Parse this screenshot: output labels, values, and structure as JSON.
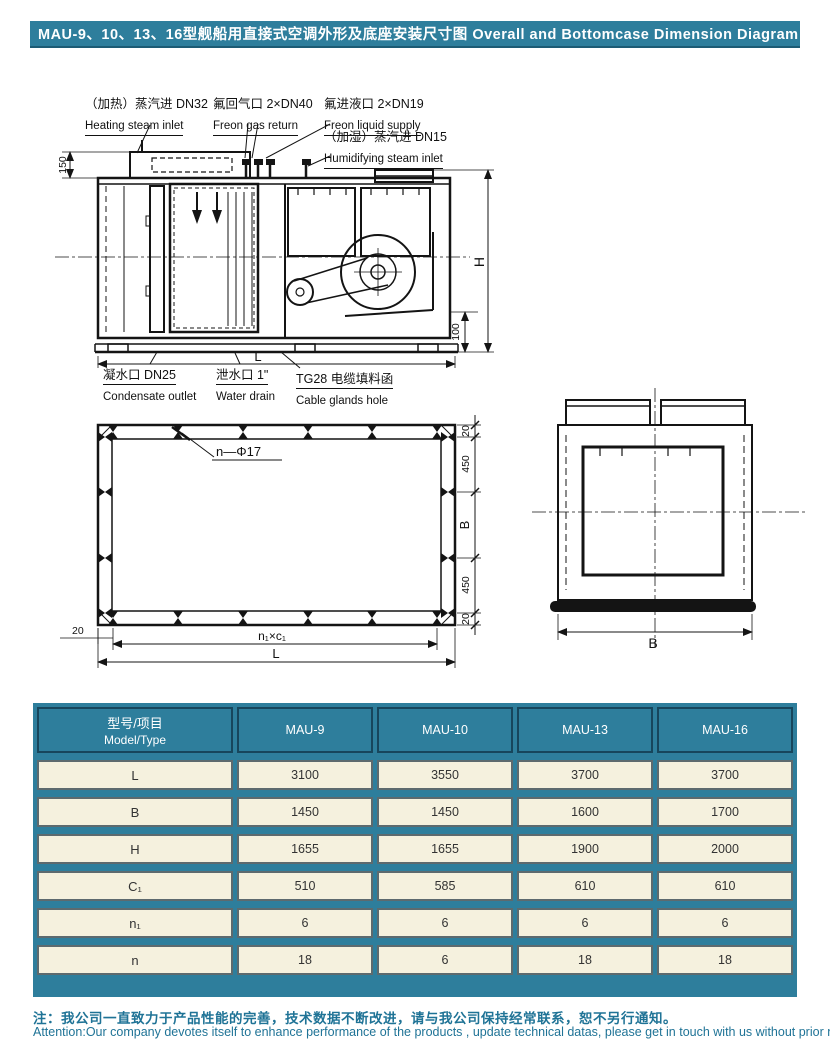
{
  "title": "MAU-9、10、13、16型舰船用直接式空调外形及底座安装尺寸图 Overall and Bottomcase Dimension Diagram",
  "diagram": {
    "labels": {
      "heating_steam": {
        "zh": "（加热）蒸汽进 DN32",
        "en": "Heating steam inlet"
      },
      "freon_gas": {
        "zh": "氟回气口 2×DN40",
        "en": "Freon gas return"
      },
      "freon_liquid": {
        "zh": "氟进液口 2×DN19",
        "en": "Freon liquid supply"
      },
      "humidifying_steam": {
        "zh": "（加湿）蒸汽进 DN15",
        "en": "Humidifying steam inlet"
      },
      "condensate": {
        "zh": "凝水口 DN25",
        "en": "Condensate outlet"
      },
      "water_drain": {
        "zh": "泄水口 1\"",
        "en": "Water drain"
      },
      "cable_glands": {
        "zh": "TG28 电缆填料函",
        "en": "Cable glands hole"
      }
    },
    "dims": {
      "d150": "150",
      "dH": "H",
      "d100": "100",
      "front_L": "L",
      "hole": "n—Φ17",
      "r20a": "20",
      "r450a": "450",
      "rB": "B",
      "r450b": "450",
      "r20b": "20",
      "left20": "20",
      "spacing": "n₁×c₁",
      "plan_L": "L",
      "end_B": "B"
    }
  },
  "table": {
    "header": {
      "model_zh": "型号/项目",
      "model_en": "Model/Type",
      "columns": [
        "MAU-9",
        "MAU-10",
        "MAU-13",
        "MAU-16"
      ]
    },
    "rows": [
      {
        "label": "L",
        "values": [
          "3100",
          "3550",
          "3700",
          "3700"
        ]
      },
      {
        "label": "B",
        "values": [
          "1450",
          "1450",
          "1600",
          "1700"
        ]
      },
      {
        "label": "H",
        "values": [
          "1655",
          "1655",
          "1900",
          "2000"
        ]
      },
      {
        "label": "C₁",
        "values": [
          "510",
          "585",
          "610",
          "610"
        ]
      },
      {
        "label": "n₁",
        "values": [
          "6",
          "6",
          "6",
          "6"
        ]
      },
      {
        "label": "n",
        "values": [
          "18",
          "6",
          "18",
          "18"
        ]
      }
    ]
  },
  "note": {
    "zh": "注：我公司一直致力于产品性能的完善，技术数据不断改进，请与我公司保持经常联系，恕不另行通知。",
    "en": "Attention:Our company devotes itself to enhance performance of the products , update technical datas, please get in touch with us without prior notice."
  },
  "colors": {
    "teal": "#2e7e9c",
    "cream": "#f5f1de",
    "line": "#141414",
    "note_text": "#1f7396"
  }
}
